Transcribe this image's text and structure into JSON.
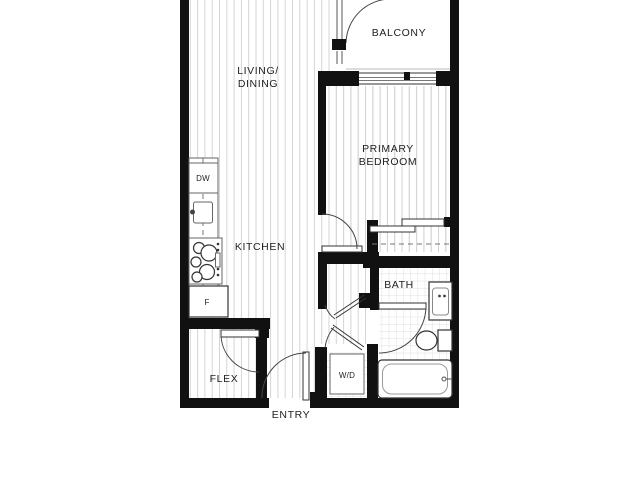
{
  "labels": {
    "balcony": "BALCONY",
    "living_line1": "LIVING/",
    "living_line2": "DINING",
    "primary_line1": "PRIMARY",
    "primary_line2": "BEDROOM",
    "kitchen": "KITCHEN",
    "bath": "BATH",
    "flex": "FLEX",
    "entry": "ENTRY",
    "wd": "W/D",
    "dw": "DW",
    "fridge": "F"
  },
  "colors": {
    "wall": "#111111",
    "line": "#444444",
    "stripe": "#d4d4d4",
    "tile": "#dfdfdf",
    "label": "#222222"
  }
}
